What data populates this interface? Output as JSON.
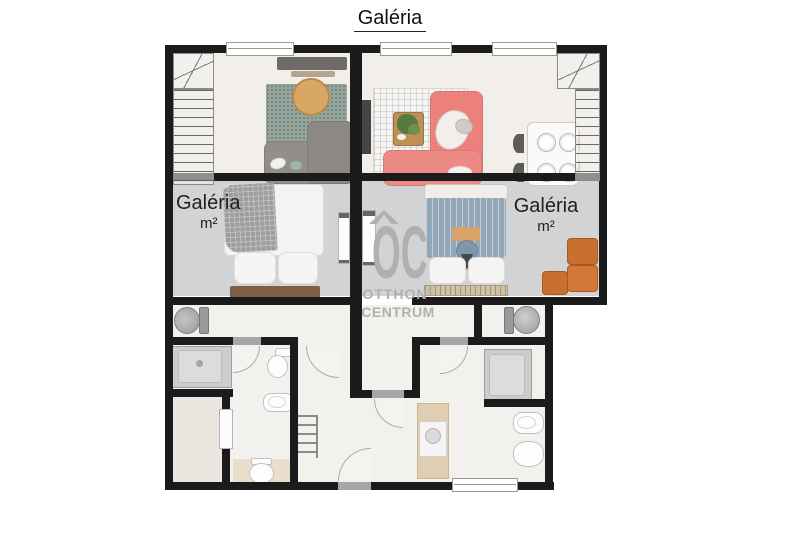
{
  "title": {
    "text": "Galéria"
  },
  "rooms": {
    "left_gallery": {
      "label": "Galéria",
      "unit": "m²"
    },
    "right_gallery": {
      "label": "Galéria",
      "unit": "m²"
    }
  },
  "watermark": {
    "logo": "OC",
    "line1": "OTTHON",
    "reg": "®",
    "line2": "CENTRUM"
  },
  "colors": {
    "wall": "#1b1b1b",
    "floor_room": "#f2efeb",
    "floor_gallery": "#d2d3d5",
    "floor_lower": "#f3f1ed",
    "floor_closet": "#eae7e1",
    "threshold": "#a6a6a6",
    "win_border": "#999999",
    "sofa_gray": "#928f8a",
    "rug_teal": "#96a69e",
    "table_wood": "#d9a765",
    "sofa_red": "#ec817c",
    "plant": "#567a40",
    "bed_gray": "#9e9ea1",
    "bed_blue": "#93a6b5",
    "pillow_tan": "#d9a368",
    "headboard": "#7d5f45",
    "footboard": "#cfc2a6",
    "orange": "#c8702f",
    "watermark": "#b0b0b0",
    "label": "#1f1f1f",
    "fixture_line": "#c2c2c2",
    "shower": "#cccccc",
    "washer_beige": "#dfceb2",
    "mat": "#e9decb",
    "tv_dark": "#474543",
    "wood_chair": "#d9c09a"
  }
}
